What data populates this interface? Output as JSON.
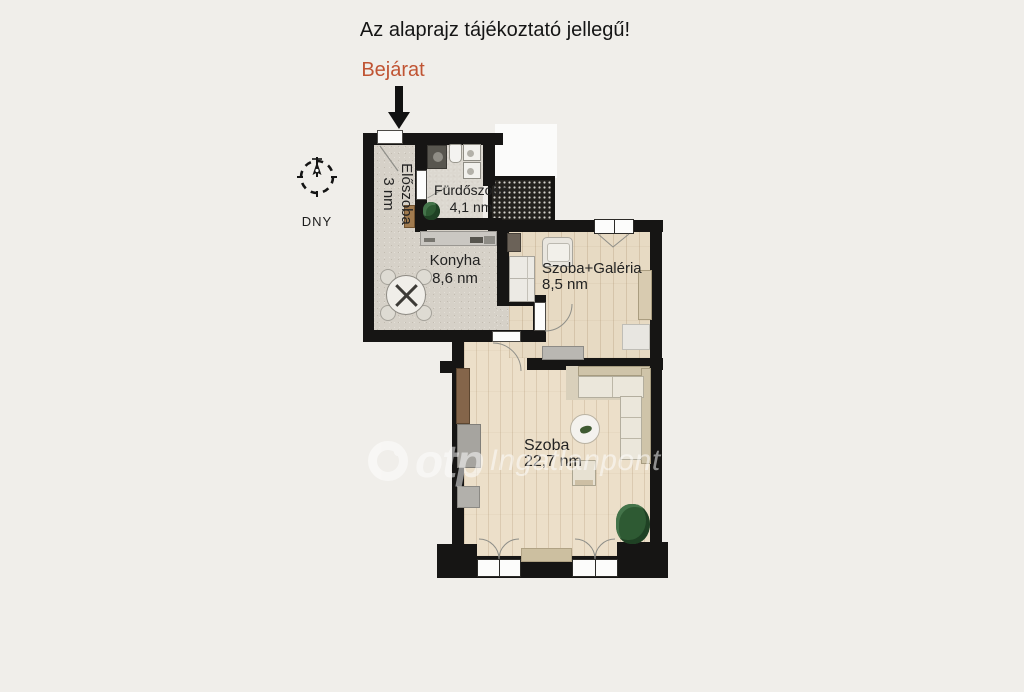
{
  "title": {
    "text": "Az alaprajz tájékoztató jellegű!"
  },
  "entrance": {
    "label": "Bejárat",
    "color": "#c05433"
  },
  "compass": {
    "label": "DNY"
  },
  "rooms": [
    {
      "name": "Előszoba",
      "area": "3 nm"
    },
    {
      "name": "Fürdőszoba",
      "area": "4,1 nm"
    },
    {
      "name": "Konyha",
      "area": "8,6 nm"
    },
    {
      "name": "Szoba+Galéria",
      "area": "8,5 nm"
    },
    {
      "name": "Szoba",
      "area": "22,7 nm"
    }
  ],
  "watermark": {
    "brand": "otp",
    "suffix": "Ingatlanpont"
  },
  "colors": {
    "wall": "#161514",
    "background": "#f0eeea",
    "accent": "#c05433"
  }
}
